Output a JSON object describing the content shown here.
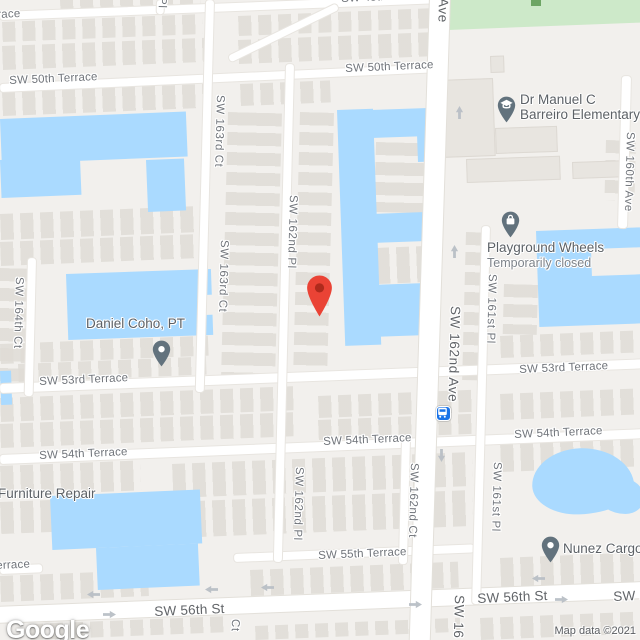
{
  "map": {
    "logo": "Google",
    "attribution": "Map data ©2021"
  },
  "colors": {
    "water": "#aadaff",
    "park": "#cde9c9",
    "road": "#ffffff",
    "land": "#f2f0ed",
    "marker_red": "#EA4335",
    "marker_red_dot": "#AE2A1C",
    "poi_pin_gray": "#62727D",
    "transit_blue": "#1a73e8"
  },
  "street_labels": [
    {
      "name": "street-label-terrace-fragment-top",
      "text": "race",
      "x": -3,
      "y": 9,
      "dir": "h",
      "major": false
    },
    {
      "name": "street-label-sw-48th-terrace",
      "text": "SW 48th Terrace",
      "x": 341,
      "y": -7,
      "dir": "h",
      "major": false
    },
    {
      "name": "street-label-sw-50th-terrace-west",
      "text": "SW 50th Terrace",
      "x": 9,
      "y": 75,
      "dir": "h",
      "major": false
    },
    {
      "name": "street-label-sw-50th-terrace-east",
      "text": "SW 50th Terrace",
      "x": 345,
      "y": 63,
      "dir": "h",
      "major": false
    },
    {
      "name": "street-label-sw-53rd-terrace-west",
      "text": "SW 53rd Terrace",
      "x": 39,
      "y": 376,
      "dir": "h",
      "major": false
    },
    {
      "name": "street-label-sw-53rd-terrace-east",
      "text": "SW 53rd Terrace",
      "x": 519,
      "y": 364,
      "dir": "h",
      "major": false
    },
    {
      "name": "street-label-sw-54th-terrace-west",
      "text": "SW 54th Terrace",
      "x": 39,
      "y": 450,
      "dir": "h",
      "major": false
    },
    {
      "name": "street-label-sw-54th-terrace-center",
      "text": "SW 54th Terrace",
      "x": 323,
      "y": 436,
      "dir": "h",
      "major": false
    },
    {
      "name": "street-label-sw-54th-terrace-east",
      "text": "SW 54th Terrace",
      "x": 514,
      "y": 429,
      "dir": "h",
      "major": false
    },
    {
      "name": "street-label-sw-55th-terrace",
      "text": "SW 55th Terrace",
      "x": 318,
      "y": 550,
      "dir": "h",
      "major": false
    },
    {
      "name": "street-label-55th-terrace-fragment",
      "text": "errace",
      "x": -4,
      "y": 560,
      "dir": "h",
      "major": false
    },
    {
      "name": "street-label-sw-56th-st-west",
      "text": "SW 56th St",
      "x": 154,
      "y": 604,
      "dir": "h",
      "major": true
    },
    {
      "name": "street-label-sw-56th-st-center",
      "text": "SW 56th St",
      "x": 477,
      "y": 591,
      "dir": "h",
      "major": true
    },
    {
      "name": "street-label-sw-56th-st-east",
      "text": "SW 56th St",
      "x": 613,
      "y": 589,
      "dir": "h",
      "major": true
    },
    {
      "name": "street-label-sw-163rd-ct-north",
      "text": "SW 163rd Ct",
      "x": 214,
      "y": 95,
      "dir": "v",
      "major": false
    },
    {
      "name": "street-label-sw-163rd-ct-south",
      "text": "SW 163rd Ct",
      "x": 218,
      "y": 240,
      "dir": "v",
      "major": false
    },
    {
      "name": "street-label-sw-162nd-pl-north",
      "text": "SW 162nd Pl",
      "x": 287,
      "y": 195,
      "dir": "v",
      "major": false
    },
    {
      "name": "street-label-sw-162nd-pl-south",
      "text": "SW 162nd Pl",
      "x": 293,
      "y": 467,
      "dir": "v",
      "major": false
    },
    {
      "name": "street-label-sw-164th-ct",
      "text": "SW 164th Ct",
      "x": 13,
      "y": 277,
      "dir": "v",
      "major": false
    },
    {
      "name": "street-label-sw-162nd-ave",
      "text": "SW 162nd Ave",
      "x": 448,
      "y": 306,
      "dir": "v",
      "major": true
    },
    {
      "name": "street-label-sw-161st-pl-north",
      "text": "SW 161st Pl",
      "x": 486,
      "y": 274,
      "dir": "v",
      "major": false
    },
    {
      "name": "street-label-sw-161st-pl-south",
      "text": "SW 161st Pl",
      "x": 491,
      "y": 462,
      "dir": "v",
      "major": false
    },
    {
      "name": "street-label-sw-160th-ave",
      "text": "SW 160th Ave",
      "x": 624,
      "y": 132,
      "dir": "v",
      "major": false
    },
    {
      "name": "street-label-sw-162nd-ct",
      "text": "SW 162nd Ct",
      "x": 408,
      "y": 463,
      "dir": "v",
      "major": false
    },
    {
      "name": "street-label-ave-fragment-top",
      "text": "Ave",
      "x": 436,
      "y": -2,
      "dir": "v",
      "major": true
    },
    {
      "name": "street-label-pl-fragment-top",
      "text": "Pl",
      "x": 156,
      "y": -3,
      "dir": "v",
      "major": false
    },
    {
      "name": "street-label-ct-fragment-bottom",
      "text": "Ct",
      "x": 229,
      "y": 619,
      "dir": "v",
      "major": false
    },
    {
      "name": "street-label-sw-16-fragment-bottom",
      "text": "SW 16",
      "x": 452,
      "y": 595,
      "dir": "v",
      "major": true
    }
  ],
  "pois": [
    {
      "name": "destination-marker",
      "icon": "red-marker-icon",
      "x": 306,
      "y": 274
    },
    {
      "name": "poi-school",
      "icon": "school-pin-icon",
      "x": 497,
      "y": 96,
      "label": {
        "x": 520,
        "y": 92,
        "lines": [
          "Dr Manuel C",
          "Barreiro Elementary"
        ]
      }
    },
    {
      "name": "poi-playground-wheels",
      "icon": "shopping-bag-pin-icon",
      "x": 501,
      "y": 211,
      "label": {
        "x": 487,
        "y": 240,
        "lines": [
          "Playground Wheels"
        ],
        "status": "Temporarily closed"
      }
    },
    {
      "name": "poi-daniel-coho-pt",
      "icon": "place-pin-icon",
      "x": 152,
      "y": 340,
      "label": {
        "x": 86,
        "y": 316,
        "lines": [
          "Daniel Coho, PT"
        ]
      }
    },
    {
      "name": "poi-furniture-repair",
      "icon": "",
      "x": 0,
      "y": 0,
      "label": {
        "x": -2,
        "y": 486,
        "lines": [
          "Furniture Repair"
        ]
      }
    },
    {
      "name": "poi-nunez-cargo",
      "icon": "place-pin-icon",
      "x": 541,
      "y": 536,
      "label": {
        "x": 563,
        "y": 541,
        "lines": [
          "Nunez Cargo"
        ]
      }
    },
    {
      "name": "transit-station",
      "icon": "bus-icon",
      "x": 436,
      "y": 406
    }
  ],
  "arrows": [
    {
      "dir": "up",
      "x": 455,
      "y": 119
    },
    {
      "dir": "up",
      "x": 450,
      "y": 258
    },
    {
      "dir": "down",
      "x": 446,
      "y": 449
    },
    {
      "dir": "left",
      "x": 100,
      "y": 599
    },
    {
      "dir": "right",
      "x": 103,
      "y": 610
    },
    {
      "dir": "left",
      "x": 218,
      "y": 594
    },
    {
      "dir": "left",
      "x": 274,
      "y": 592
    },
    {
      "dir": "right",
      "x": 409,
      "y": 600
    },
    {
      "dir": "left",
      "x": 545,
      "y": 583
    },
    {
      "dir": "right",
      "x": 555,
      "y": 595
    }
  ]
}
